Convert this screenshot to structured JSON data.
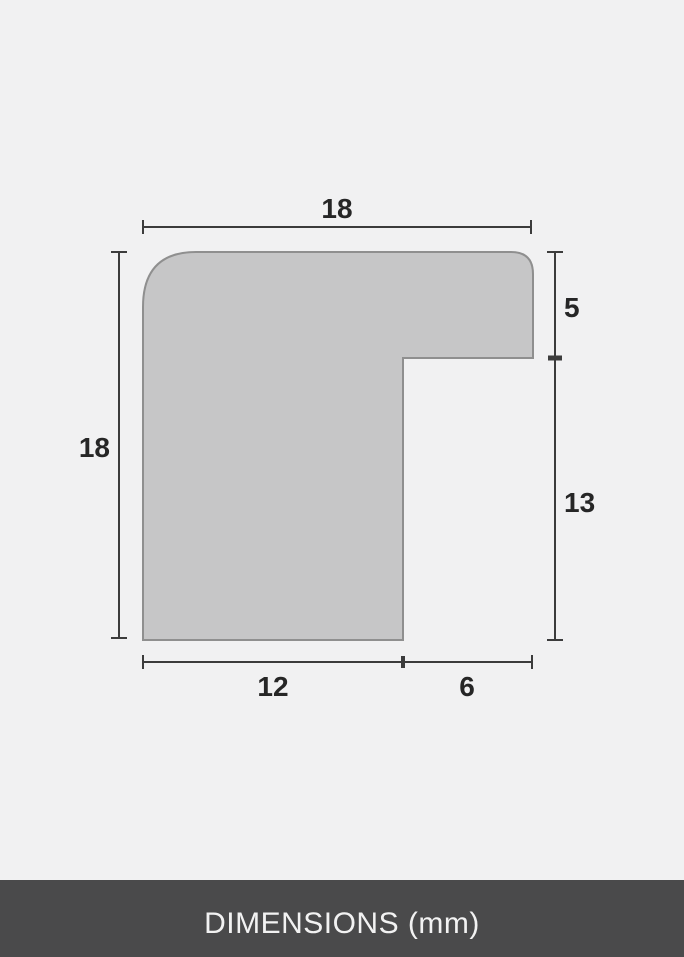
{
  "diagram": {
    "kind": "frame-profile-cross-section",
    "dimensions": {
      "top_width": "18",
      "left_height": "18",
      "right_upper_height": "5",
      "right_lower_height": "13",
      "bottom_inner_width": "12",
      "bottom_outer_width": "6"
    },
    "colors": {
      "background": "#f1f1f2",
      "shape_fill": "#c6c6c7",
      "shape_stroke": "#8f8f8f",
      "dimension_line": "#3c3c3c",
      "label_text": "#262626",
      "footer_background": "#4a4a4b",
      "footer_text": "#f2f2f2"
    }
  },
  "footer": {
    "label": "DIMENSIONS (mm)"
  }
}
